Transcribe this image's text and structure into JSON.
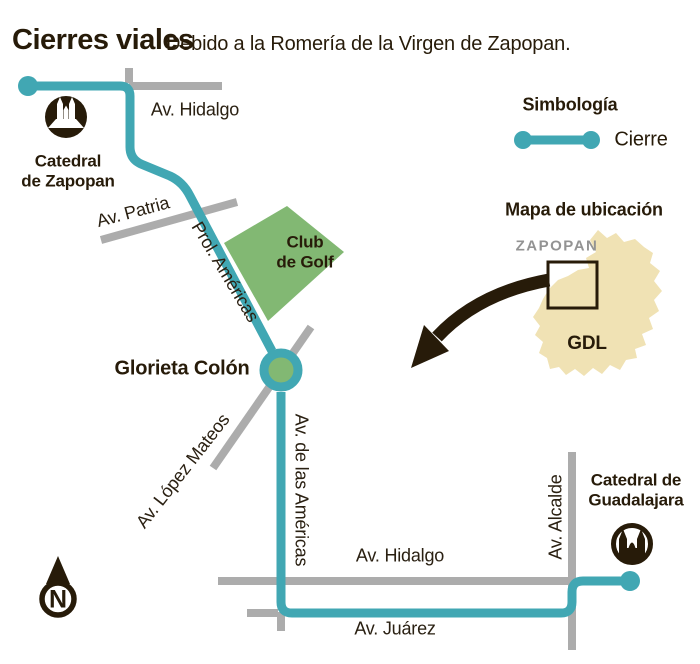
{
  "header": {
    "title": "Cierres viales",
    "subtitle": "Debido a la Romería de la Virgen de Zapopan."
  },
  "legend": {
    "heading": "Simbología",
    "closure_label": "Cierre"
  },
  "locator": {
    "heading": "Mapa de ubicación",
    "region_top": "ZAPOPAN",
    "region_bottom": "GDL"
  },
  "map": {
    "streets": {
      "hidalgo_top": "Av. Hidalgo",
      "patria": "Av. Patria",
      "prol_americas": "Prol. Américas",
      "lopez_mateos": "Av. López Mateos",
      "de_las_americas": "Av. de las Américas",
      "hidalgo_bottom": "Av. Hidalgo",
      "juarez": "Av. Juárez",
      "alcalde": "Av. Alcalde"
    },
    "places": {
      "catedral_zapopan_line1": "Catedral",
      "catedral_zapopan_line2": "de Zapopan",
      "club_golf_line1": "Club",
      "club_golf_line2": "de Golf",
      "glorieta": "Glorieta Colón",
      "catedral_gdl_line1": "Catedral de",
      "catedral_gdl_line2": "Guadalajara"
    },
    "compass_label": "N"
  },
  "colors": {
    "closure_teal": "#41A7B3",
    "road_gray": "#ACACAC",
    "park_green": "#82B873",
    "locator_beige": "#F0E2B4",
    "ink_dark": "#271B09",
    "muted_gray_text": "#939393"
  }
}
